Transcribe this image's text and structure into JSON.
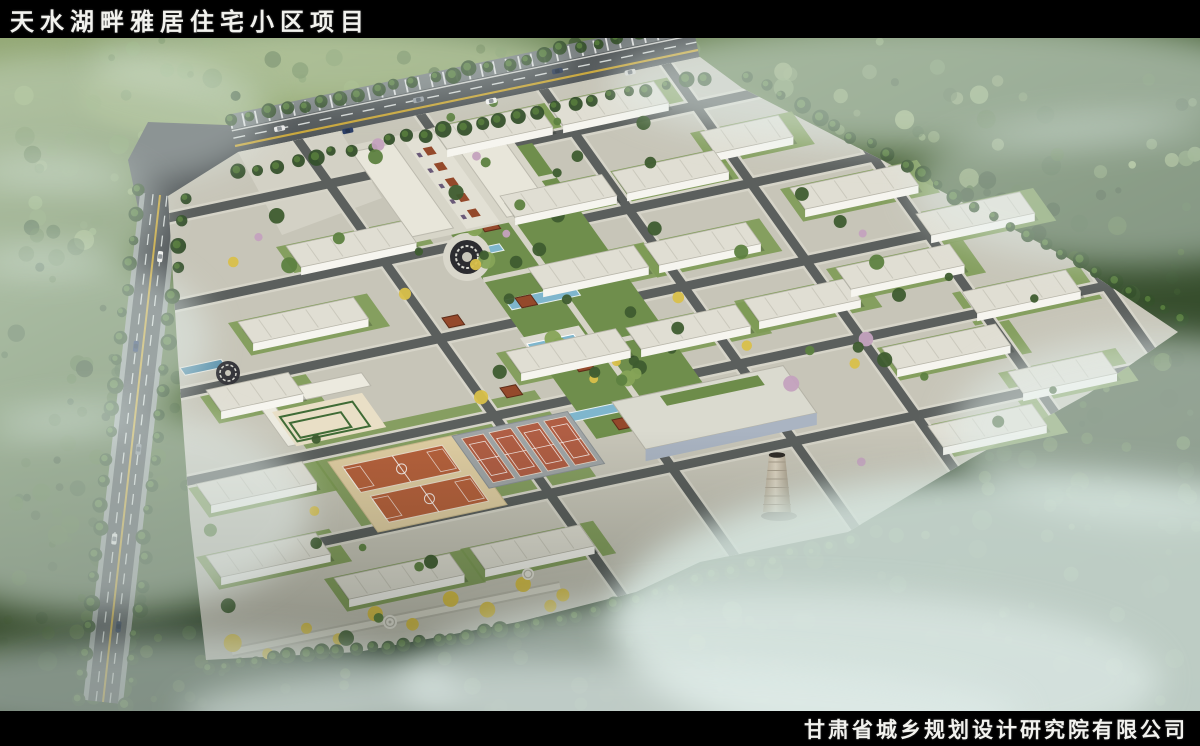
{
  "header": {
    "title": "天水湖畔雅居住宅小区项目"
  },
  "footer": {
    "company": "甘肃省城乡规划设计研究院有限公司"
  },
  "palette": {
    "bar_bg": "#000000",
    "bar_text": "#f2f2ee",
    "forest_light": "#93a873",
    "forest_mid": "#5d7747",
    "forest_dark": "#2c4026",
    "asphalt": "#50555600",
    "road": "#53585a",
    "road_line_yellow": "#c9a73c",
    "road_dash_white": "#d3d7d5",
    "site_paving": "#c7c5b8",
    "lawn": "#7d9a55",
    "park_green": "#6f8e4c",
    "building_roof": "#e0ded3",
    "building_face": "#f6f5ef",
    "building_side": "#c4c2b6",
    "water": "#5d93ad",
    "pool": "#7fb6cd",
    "basketball_court": "#b5613c",
    "court_apron": "#dfcda2",
    "tennis_court": "#b05e44",
    "tennis_apron": "#a0a5a6",
    "pavilion_red": "#94492b",
    "tree_yellow": "#d9c04a",
    "blossom_pink": "#c4a2be",
    "chimney": "#d3cab8",
    "mist": "#e3efec"
  }
}
